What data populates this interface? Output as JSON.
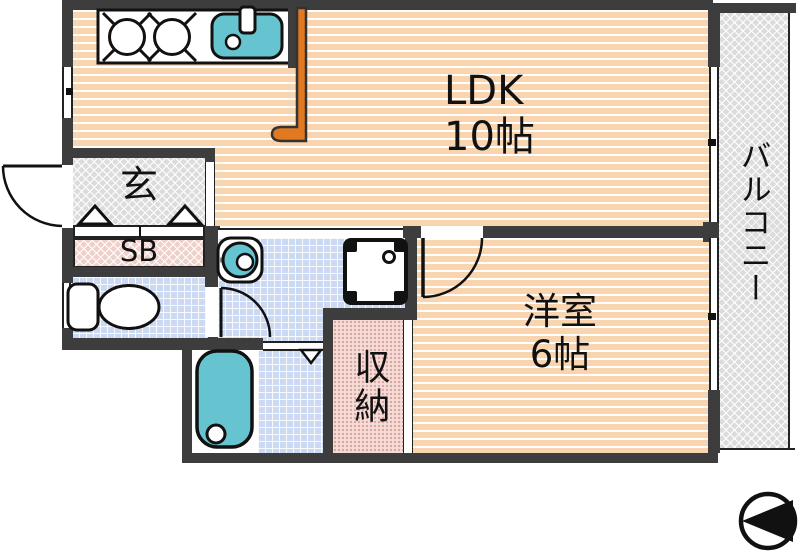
{
  "plan": {
    "rooms": {
      "ldk": {
        "label": "LDK",
        "size": "10帖"
      },
      "western_room": {
        "label": "洋室",
        "size": "6帖"
      },
      "entrance": {
        "label": "玄"
      },
      "shoe_box": {
        "label": "SB"
      },
      "storage": {
        "label": "収納"
      },
      "balcony": {
        "label": "バルコニー"
      }
    },
    "fixtures": [
      "kitchen-counter",
      "stove-burners",
      "kitchen-sink",
      "counter-partition",
      "entrance-door",
      "entrance-step-arrows",
      "toilet",
      "toilet-door",
      "washbasin",
      "washing-machine-pan",
      "bathtub",
      "bath-folding-door",
      "western-room-door",
      "compass"
    ],
    "compass": {
      "points": "left"
    },
    "colors": {
      "wall": "#3D3D3D",
      "floor_stripe": "#F8D5AE",
      "tile_blue": "#CBD9F2",
      "hatch_gray": "#DCDCDC",
      "shoe_box_pink": "#EFD0CB",
      "storage_pink": "#F6DCD8",
      "fixture_teal": "#66C4D0",
      "counter_orange": "#E0791F"
    }
  }
}
